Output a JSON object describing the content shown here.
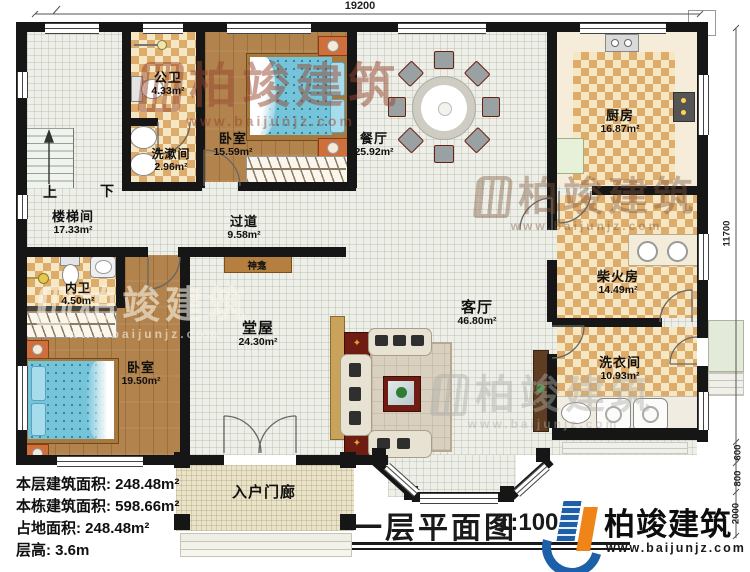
{
  "title_block": {
    "title": "一层平面图",
    "scale": "1:100"
  },
  "brand": {
    "name": "柏竣建筑",
    "website": "www.baijunjz.com"
  },
  "watermark": {
    "name": "柏竣建筑",
    "website": "www.baijunjz.com"
  },
  "dimensions": {
    "top": "19200",
    "right": "11700",
    "seg1": "600",
    "seg2": "800",
    "seg3": "2000"
  },
  "stats": {
    "line1": "本层建筑面积: 248.48m²",
    "line2": "本栋建筑面积: 598.66m²",
    "line3": "占地面积: 248.48m²",
    "line4": "层高: 3.6m"
  },
  "stairs": {
    "up": "上",
    "down": "下"
  },
  "rooms": {
    "gongwei": {
      "name": "公卫",
      "area": "4.33m²"
    },
    "xishujian": {
      "name": "洗漱间",
      "area": "2.96m²"
    },
    "woshi1": {
      "name": "卧室",
      "area": "15.59m²"
    },
    "canting": {
      "name": "餐厅",
      "area": "25.92m²"
    },
    "chufang": {
      "name": "厨房",
      "area": "16.87m²"
    },
    "loutijian": {
      "name": "楼梯间",
      "area": "17.33m²"
    },
    "guodao": {
      "name": "过道",
      "area": "9.58m²"
    },
    "shenkan": {
      "name": "神龛"
    },
    "neiwei": {
      "name": "内卫",
      "area": "4.50m²"
    },
    "chaihuofang": {
      "name": "柴火房",
      "area": "14.49m²"
    },
    "woshi2": {
      "name": "卧室",
      "area": "19.50m²"
    },
    "tangwu": {
      "name": "堂屋",
      "area": "24.30m²"
    },
    "keting": {
      "name": "客厅",
      "area": "46.80m²"
    },
    "xiyijian": {
      "name": "洗衣间",
      "area": "10.93m²"
    },
    "rumenlang": {
      "name": "入户门廊"
    }
  },
  "colors": {
    "wall": "#161616",
    "wood_floor": "#b2834c",
    "tile_floor": "#edefe8",
    "checker_light": "#f6e7c4",
    "checker_dark": "#ddab6a",
    "porch_floor": "#eae3c7",
    "marble": "#f5ecda",
    "bed_blue": "#74c4da",
    "cabinet_red": "#6f1d12",
    "logo_blue": "#1d5fa8",
    "logo_orange": "#ef8418"
  }
}
